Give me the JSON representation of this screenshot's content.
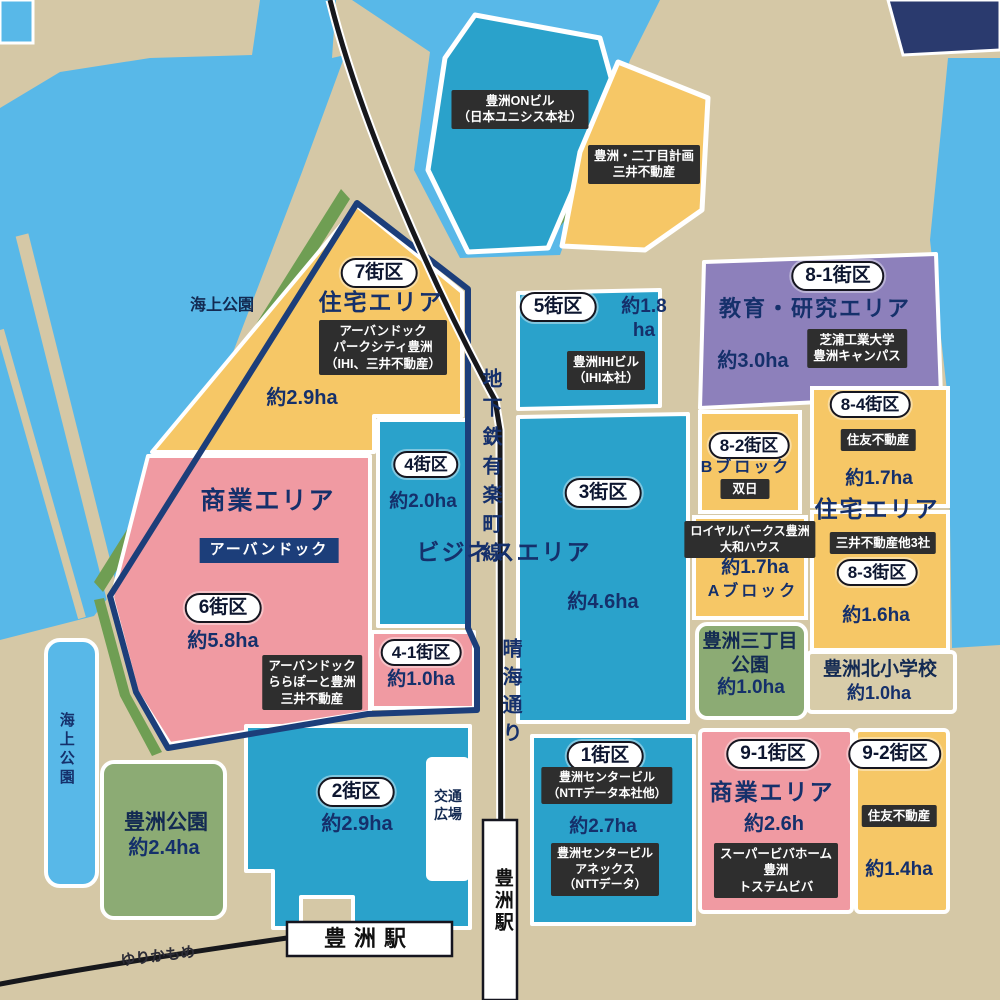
{
  "colors": {
    "land_tan": "#d5c8a6",
    "water_blue": "#58b8e8",
    "district_teal": "#2aa2cb",
    "district_yellow": "#f6c766",
    "district_pink": "#f09aa2",
    "district_purple": "#8d80bb",
    "park_green": "#8cab74",
    "coast_green": "#6f9e53",
    "navy_border": "#1c3e7a",
    "label_black": "#2e2e2e",
    "text_navy": "#15306b",
    "corner_navy": "#2a3a6e"
  },
  "t": {
    "kaijo_top": "海上公園",
    "kaijo_bottom": "海上公園",
    "on_bldg": "豊洲ONビル\n（日本ユニシス本社）",
    "nichome": "豊洲・二丁目計画\n三井不動産",
    "b7_pill": "7街区",
    "b7_type": "住宅エリア",
    "b7_tenant": "アーバンドック\nパークシティ豊洲\n（IHI、三井不動産）",
    "b7_area": "約2.9ha",
    "metro_line": "地下鉄有楽町線",
    "b5_pill": "5街区",
    "b5_area": "約1.8\nha",
    "b5_tenant": "豊洲IHIビル\n（IHI本社）",
    "b81_pill": "8-1街区",
    "b81_type": "教育・研究エリア",
    "b81_area": "約3.0ha",
    "b81_tenant": "芝浦工業大学\n豊洲キャンパス",
    "b4_pill": "4街区",
    "b4_area": "約2.0ha",
    "b3_pill": "3街区",
    "b3_area": "約4.6ha",
    "business": "ビジネスエリア",
    "b6_pill": "6街区",
    "b6_type": "商業エリア",
    "b6_area": "約5.8ha",
    "urban_dock": "アーバンドック",
    "b6_tenant": "アーバンドック\nららぽーと豊洲\n三井不動産",
    "b41_pill": "4-1街区",
    "b41_area": "約1.0ha",
    "harumi": "晴海通り",
    "b82_pill": "8-2街区",
    "b82_block": "Bブロック",
    "b82_tenant": "双日",
    "a_tenant": "ロイヤルパークス豊洲\n大和ハウス",
    "a_area": "約1.7ha",
    "a_block": "Aブロック",
    "b84_pill": "8-4街区",
    "b84_tenant": "住友不動産",
    "b84_area": "約1.7ha",
    "resid_right": "住宅エリア",
    "mitsui3": "三井不動産他3社",
    "b83_pill": "8-3街区",
    "b83_area": "約1.6ha",
    "sanchome_name": "豊洲三丁目\n公園",
    "sanchome_area": "約1.0ha",
    "kita_name": "豊洲北小学校",
    "kita_area": "約1.0ha",
    "b2_pill": "2街区",
    "b2_area": "約2.9ha",
    "traffic": "交通\n広場",
    "b1_pill": "1街区",
    "b1_tenant1": "豊洲センタービル\n（NTTデータ本社他）",
    "b1_area": "約2.7ha",
    "b1_tenant2": "豊洲センタービル\nアネックス\n（NTTデータ）",
    "b91_pill": "9-1街区",
    "b91_type": "商業エリア",
    "b91_area": "約2.6h",
    "b91_tenant": "スーパービバホーム\n豊洲\nトステムビバ",
    "b92_pill": "9-2街区",
    "b92_tenant": "住友不動産",
    "b92_area": "約1.4ha",
    "toyosu_park": "豊洲公園",
    "toyosu_park_area": "約2.4ha",
    "sta_h": "豊洲駅",
    "sta_v": "豊洲駅",
    "yurikamome": "ゆりかもめ"
  }
}
